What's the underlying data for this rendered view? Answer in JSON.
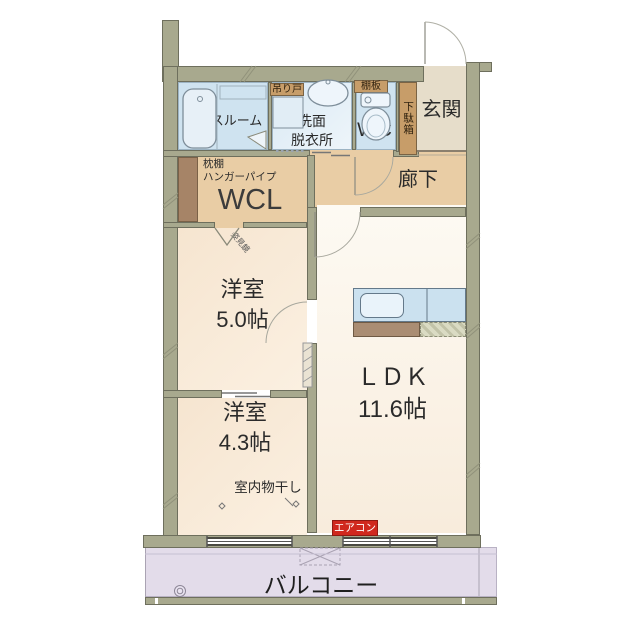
{
  "rooms": {
    "bathroom": "バスルーム",
    "hanging_door": "吊り戸",
    "washroom_l1": "洗面",
    "washroom_l2": "脱衣所",
    "shelf_board": "棚板",
    "toilet": "WC",
    "shoe_cabinet": "下駄箱",
    "entrance": "玄関",
    "corridor": "廊下",
    "closet": "WCL",
    "closet_shelf": "枕棚",
    "closet_pipe": "ハンガーパイプ",
    "closet_mirror": "姿見鏡",
    "bedroom1_name": "洋室",
    "bedroom1_size": "5.0帖",
    "bedroom2_name": "洋室",
    "bedroom2_size": "4.3帖",
    "indoor_drying": "室内物干し",
    "ldk_name": "ＬＤＫ",
    "ldk_size": "11.6帖",
    "aircon": "エアコン",
    "balcony": "バルコニー"
  },
  "colors": {
    "wall": "#a8a98e",
    "water_room": "#cfe3f0",
    "hall": "#e9cda5",
    "western_room": "#f8e9d5",
    "ldk": "#fbf5ea",
    "balcony": "#e3dcea",
    "label_brown": "#c79d69",
    "aircon_red": "#d0281e"
  }
}
